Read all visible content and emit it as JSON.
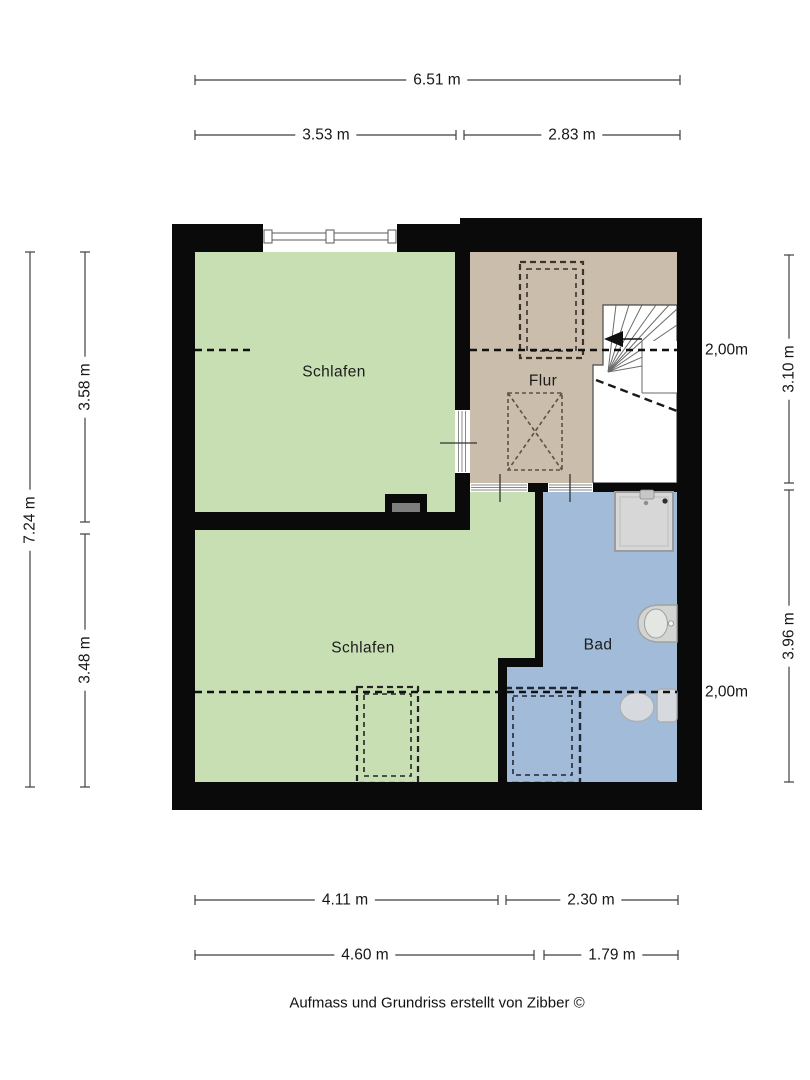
{
  "rooms": {
    "bedroom_top": {
      "label": "Schlafen"
    },
    "hallway": {
      "label": "Flur"
    },
    "bedroom_bottom": {
      "label": "Schlafen"
    },
    "bathroom": {
      "label": "Bad"
    }
  },
  "dimensions": {
    "top_total": "6.51 m",
    "top_left": "3.53 m",
    "top_right": "2.83 m",
    "left_total": "7.24 m",
    "left_upper": "3.58 m",
    "left_lower": "3.48 m",
    "right_upper": "3.10 m",
    "right_lower": "3.96 m",
    "bottom_row1_left": "4.11 m",
    "bottom_row1_right": "2.30 m",
    "bottom_row2_left": "4.60 m",
    "bottom_row2_right": "1.79 m"
  },
  "height_markers": {
    "hallway": "2,00m",
    "bathroom": "2,00m"
  },
  "footer": {
    "credit": "Aufmass und Grundriss erstellt von Zibber ©"
  },
  "fixtures": [
    "stairs",
    "shower",
    "washbasin",
    "toilet",
    "chimney",
    "window",
    "wardrobe-outline",
    "dashed-box-outline"
  ],
  "colors": {
    "wall": "#0a0a0a",
    "bedroom_floor": "#c8dfb4",
    "hallway_floor": "#cabdac",
    "bathroom_floor": "#a2bbd8",
    "stairs_floor": "#ffffff"
  }
}
